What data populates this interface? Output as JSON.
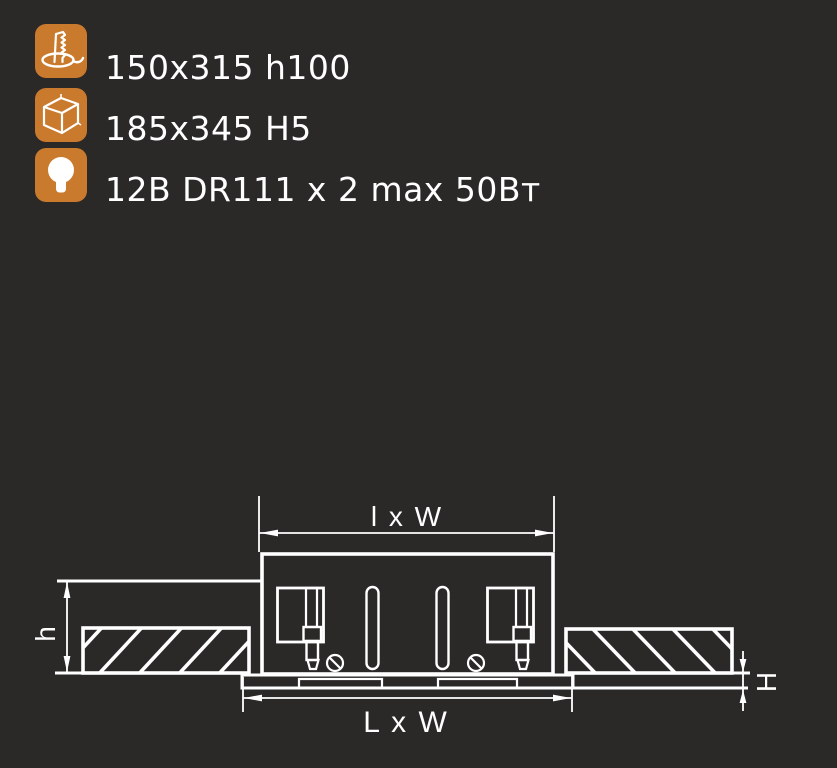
{
  "theme": {
    "background": "#2b2828",
    "icon_color": "#c97a2d",
    "line_color": "#ffffff"
  },
  "specs": [
    {
      "icon": "cutout-icon",
      "label": "150x315 h100"
    },
    {
      "icon": "box-icon",
      "label": "185x345 H5"
    },
    {
      "icon": "lamp-icon",
      "label": "12В DR111 x 2 max 50Вт"
    }
  ],
  "diagram": {
    "labels": {
      "top": "l x W",
      "bottom": "L x W",
      "left": "h",
      "right": "H"
    }
  }
}
